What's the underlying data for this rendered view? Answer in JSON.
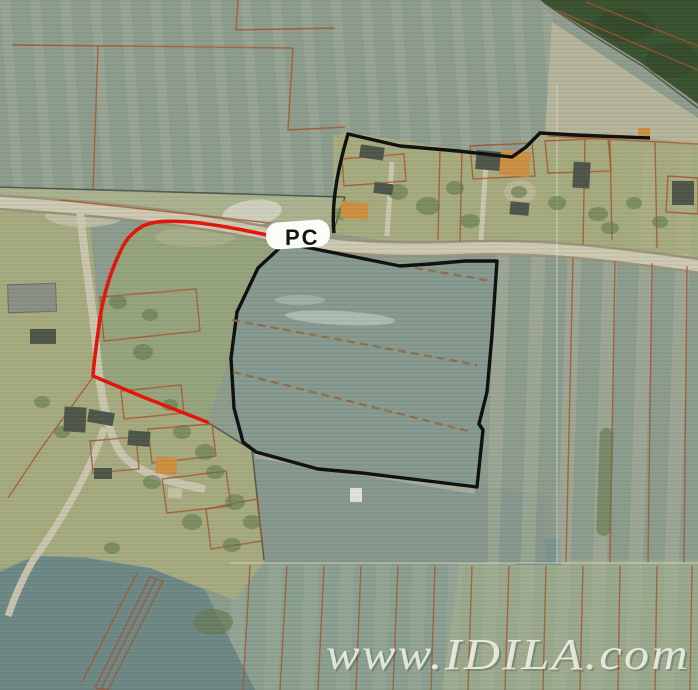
{
  "map": {
    "parcel_label": "PC",
    "watermark": "www.IDILA.com",
    "colors": {
      "highlight_red": "#e31508",
      "boundary_black": "#0e0e0e",
      "cadastral_line": "#a8512a",
      "road": "#ccc8b2",
      "road_edge": "#9b9478",
      "field_base": "#8d9c8d",
      "field_parcel": "#86998e",
      "village_green": "#a6aa7e",
      "grass_green": "#96a47c",
      "forest_green": "#3a522f",
      "dark_field": "#6c8784",
      "pale_field": "#b6b49a",
      "building_dark": "#4d5549",
      "building_orange": "#cd8f3f",
      "tree_green": "#64794d",
      "pc_patch": "#fbfbf7",
      "watermark_white": "#f8f8ef"
    }
  }
}
